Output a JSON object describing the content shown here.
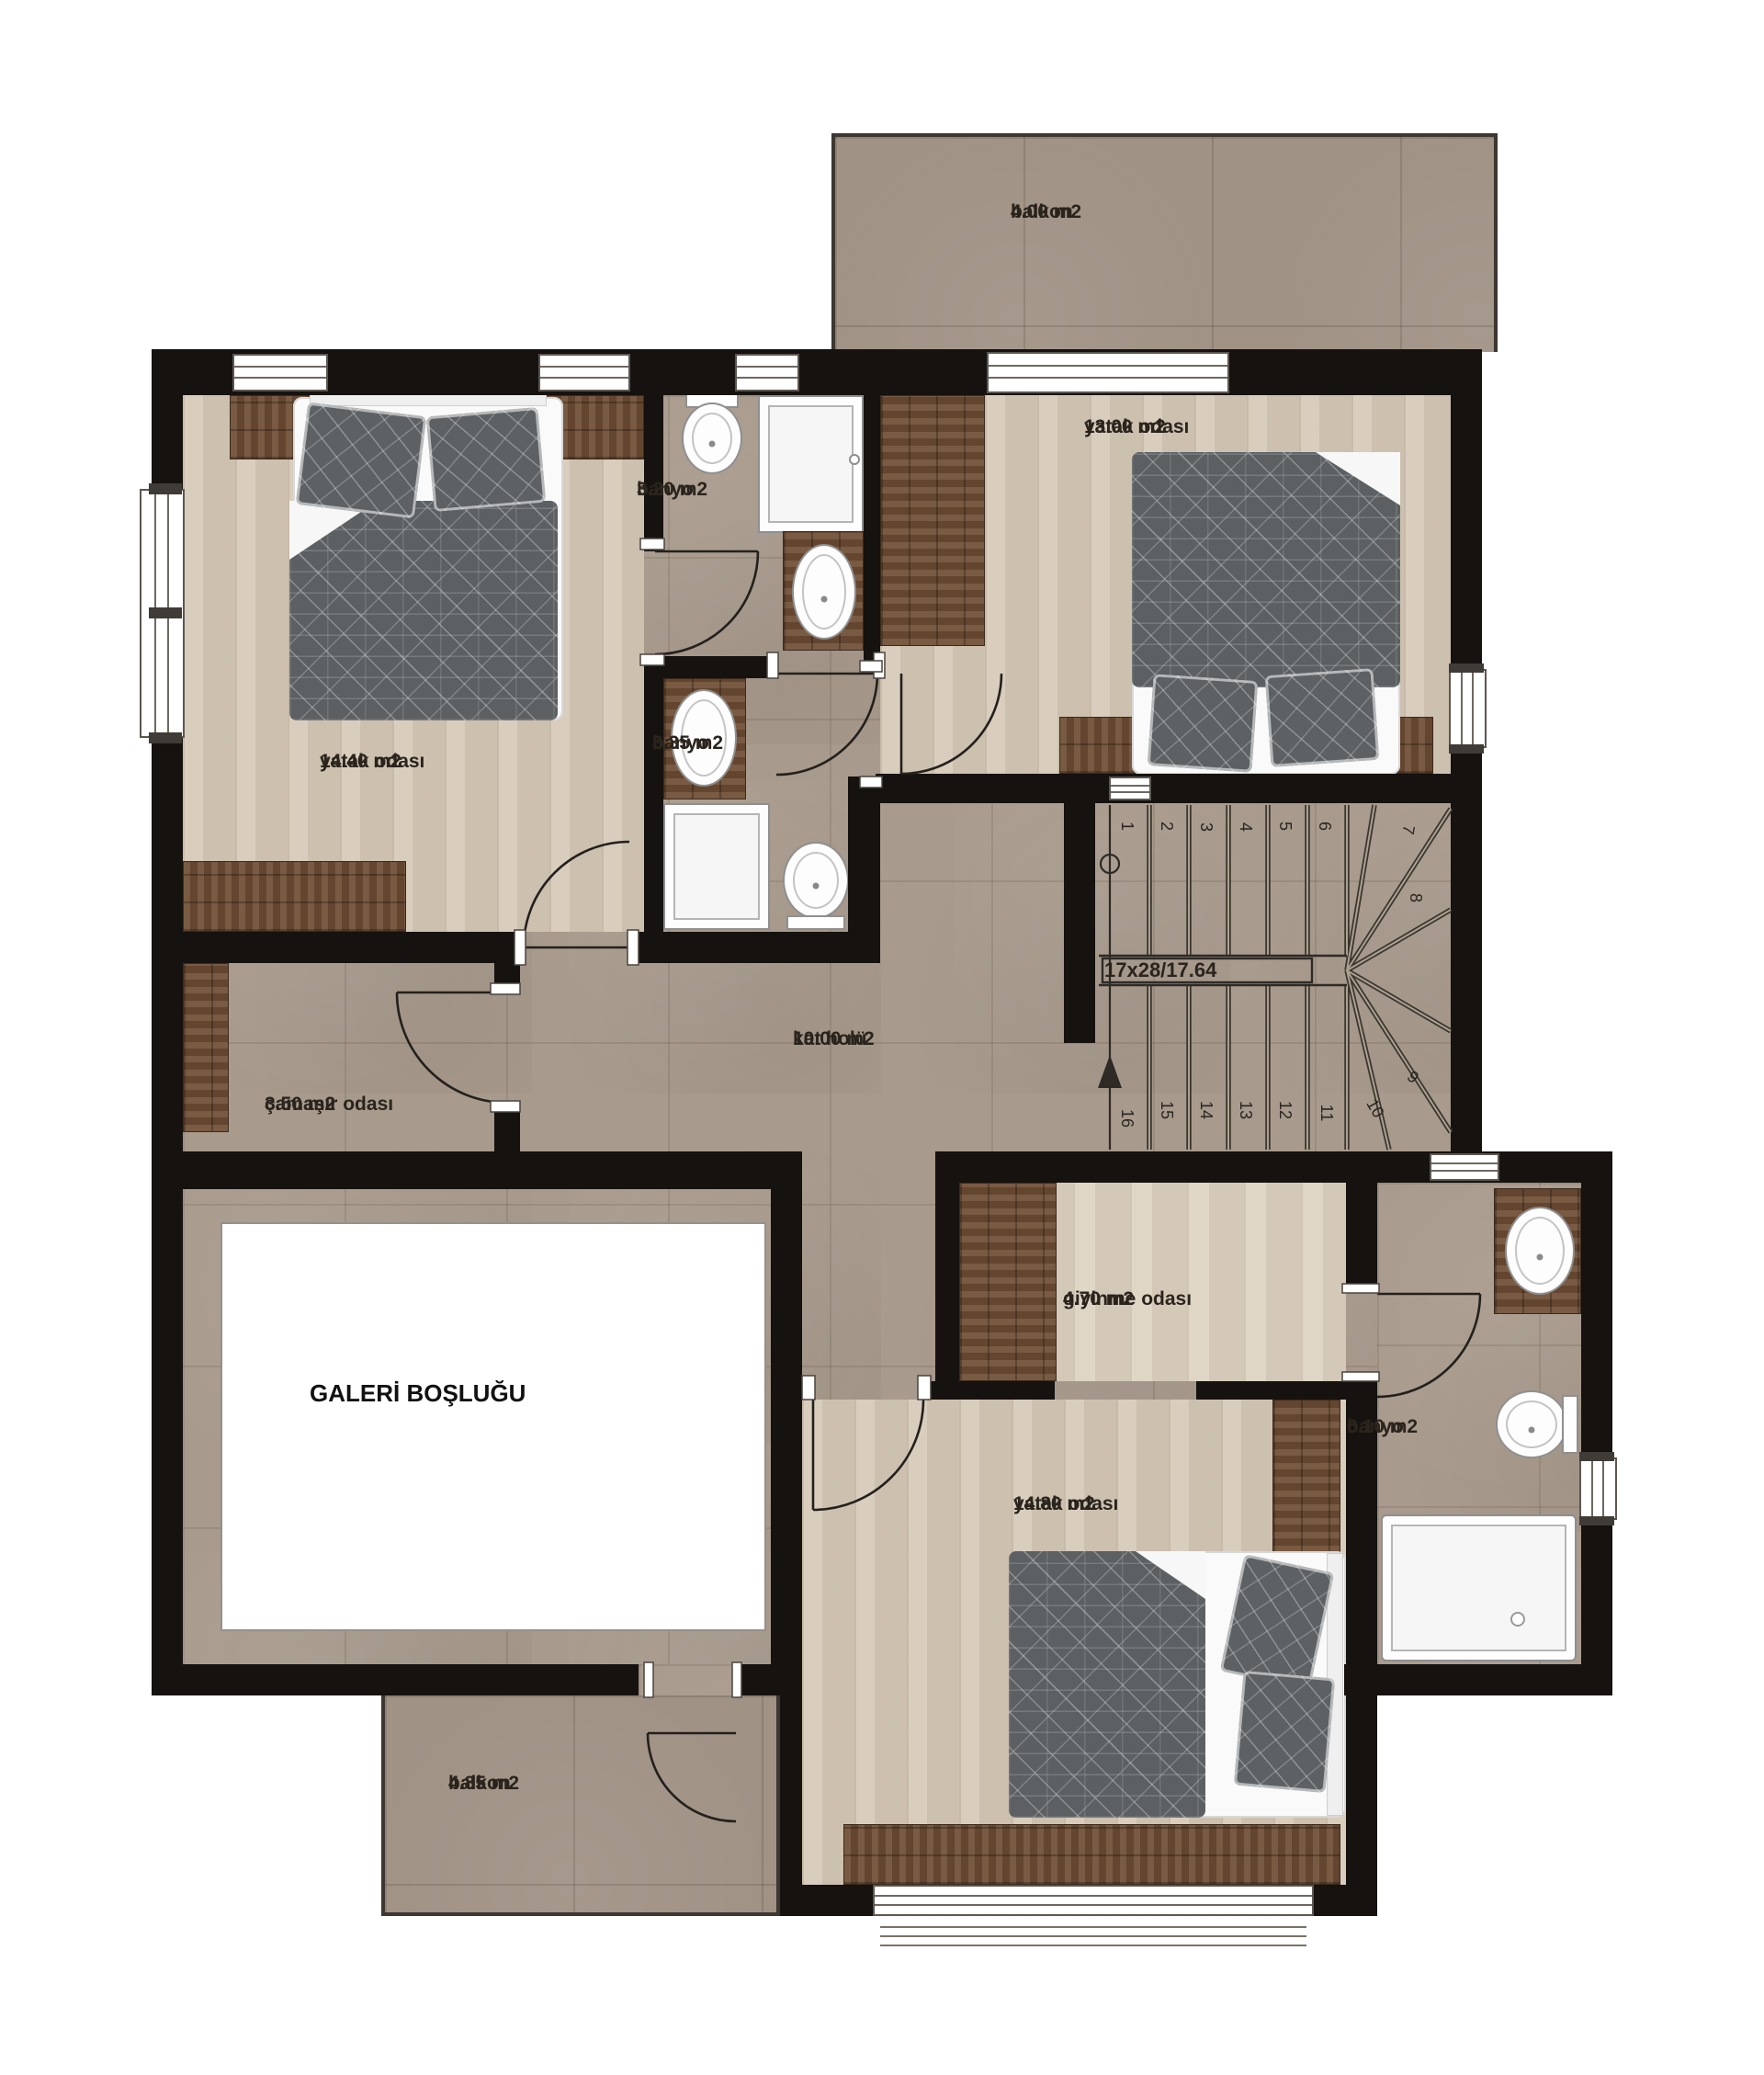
{
  "plan": {
    "title": "floor-plan-upper-level",
    "rooms": {
      "balcony_top": {
        "name": "balkon",
        "area": "4.00 m2"
      },
      "bedroom_left": {
        "name": "yatak odası",
        "area": "14.40 m2"
      },
      "bathroom_top": {
        "name": "banyo",
        "area": "3.20 m2"
      },
      "bathroom_mid": {
        "name": "banyo",
        "area": "3.35 m2"
      },
      "bedroom_topright": {
        "name": "yatak odası",
        "area": "13.00 m2"
      },
      "hall": {
        "name": "kat holü",
        "area": "10.00 m2"
      },
      "laundry": {
        "name": "çamaşır odası",
        "area": "3.50 m2"
      },
      "gallery_void": {
        "name": "GALERİ BOŞLUĞU"
      },
      "dressing": {
        "name": "giyinme odası",
        "area": "4.70 m2"
      },
      "bathroom_right": {
        "name": "banyo",
        "area": "6.10 m2"
      },
      "bedroom_bottom": {
        "name": "yatak odası",
        "area": "14.80 m2"
      },
      "balcony_bottom": {
        "name": "balkon",
        "area": "4.85 m2"
      }
    },
    "stairs": {
      "label": "17x28/17.64",
      "steps": [
        "1",
        "2",
        "3",
        "4",
        "5",
        "6",
        "7",
        "8",
        "9",
        "10",
        "11",
        "12",
        "13",
        "14",
        "15",
        "16"
      ]
    },
    "colors": {
      "wall": "#15120f",
      "tile": "#a89a8c",
      "wood_light": "#d5c9b8",
      "wood_dark": "#6f4d34",
      "duvet": "#5c6063",
      "background": "#ffffff"
    }
  }
}
